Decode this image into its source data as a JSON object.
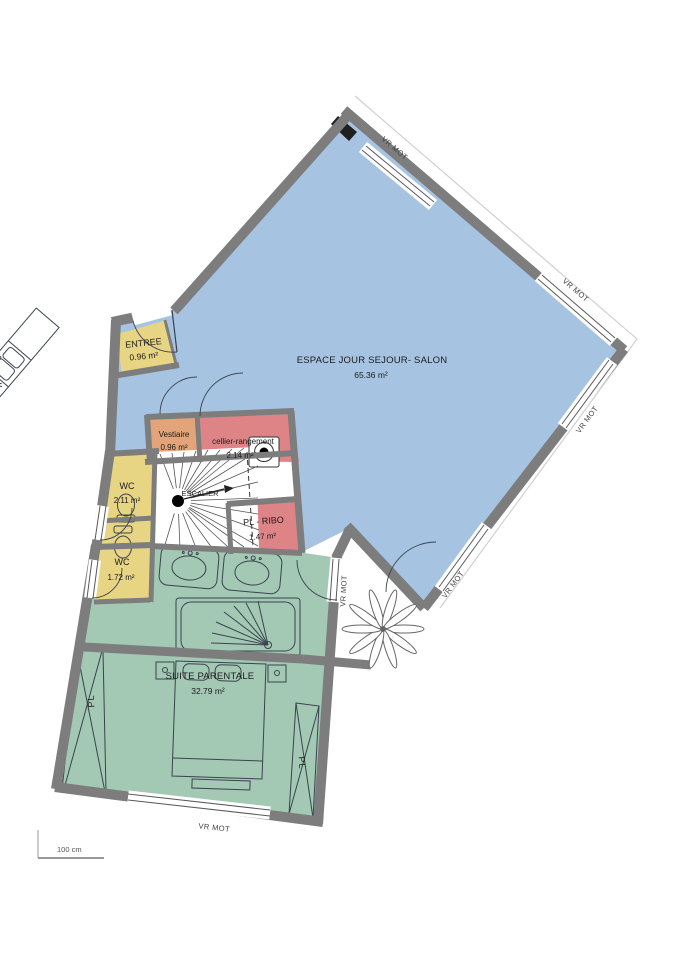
{
  "plan": {
    "rooms": {
      "living": {
        "name": "ESPACE JOUR  SEJOUR- SALON",
        "area": "65.36 m²"
      },
      "entree": {
        "name": "ENTREE",
        "area": "0.96 m²"
      },
      "vestiaire": {
        "name": "Vestiaire",
        "area": "0.96 m²"
      },
      "cellier": {
        "name": "cellier-rangement",
        "area": "2.14 m²"
      },
      "wc1": {
        "name": "WC",
        "area": "2.11 m²"
      },
      "escalier": {
        "name": "ESCALIER",
        "area": ""
      },
      "plribo": {
        "name": "PL - RIBO",
        "area": "1.47 m²"
      },
      "wc2": {
        "name": "WC",
        "area": "1.72 m²"
      },
      "suite": {
        "name": "SUITE PARENTALE",
        "area": "32.79 m²"
      }
    },
    "labels": {
      "shutter": "VR MOT",
      "closet": "PL",
      "scale": "100 cm"
    },
    "colors": {
      "living": "#a6c3e1",
      "suite": "#a3c8b4",
      "wet": "#e7d584",
      "storage": "#df8486",
      "vestiaire": "#e2a478",
      "wall": "#7d7d7d"
    }
  }
}
